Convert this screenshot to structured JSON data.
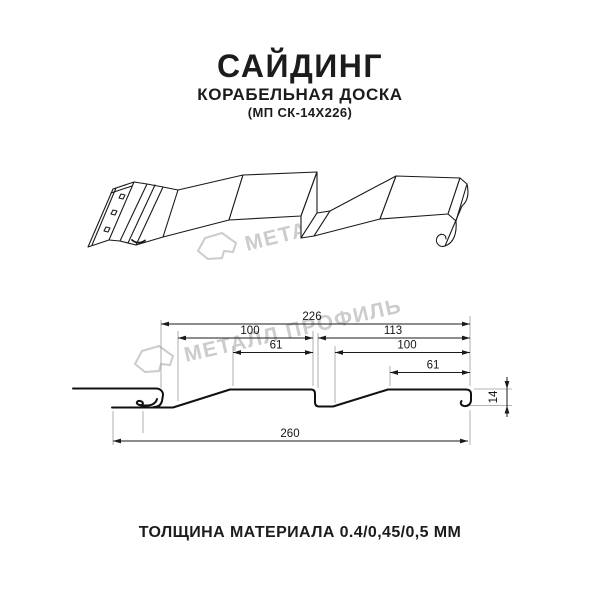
{
  "header": {
    "title": "САЙДИНГ",
    "subtitle": "КОРАБЕЛЬНАЯ ДОСКА",
    "model": "(МП СК-14Х226)"
  },
  "footer": {
    "thickness_note": "ТОЛЩИНА МАТЕРИАЛА 0.4/0,45/0,5 ММ"
  },
  "watermark": {
    "text": "МЕТАЛЛ ПРОФИЛЬ"
  },
  "dimensions": {
    "top_width": "226",
    "left_upper": "100",
    "right_upper": "113",
    "left_inner": "61",
    "right_inner": "100",
    "right_inner2": "61",
    "bottom_width": "260",
    "height": "14"
  },
  "colors": {
    "line": "#1a1a1a",
    "dimension": "#1a1a1a",
    "extension": "#9b9b9b",
    "watermark": "#cccccc",
    "text": "#1c1c1c",
    "background": "#ffffff"
  }
}
